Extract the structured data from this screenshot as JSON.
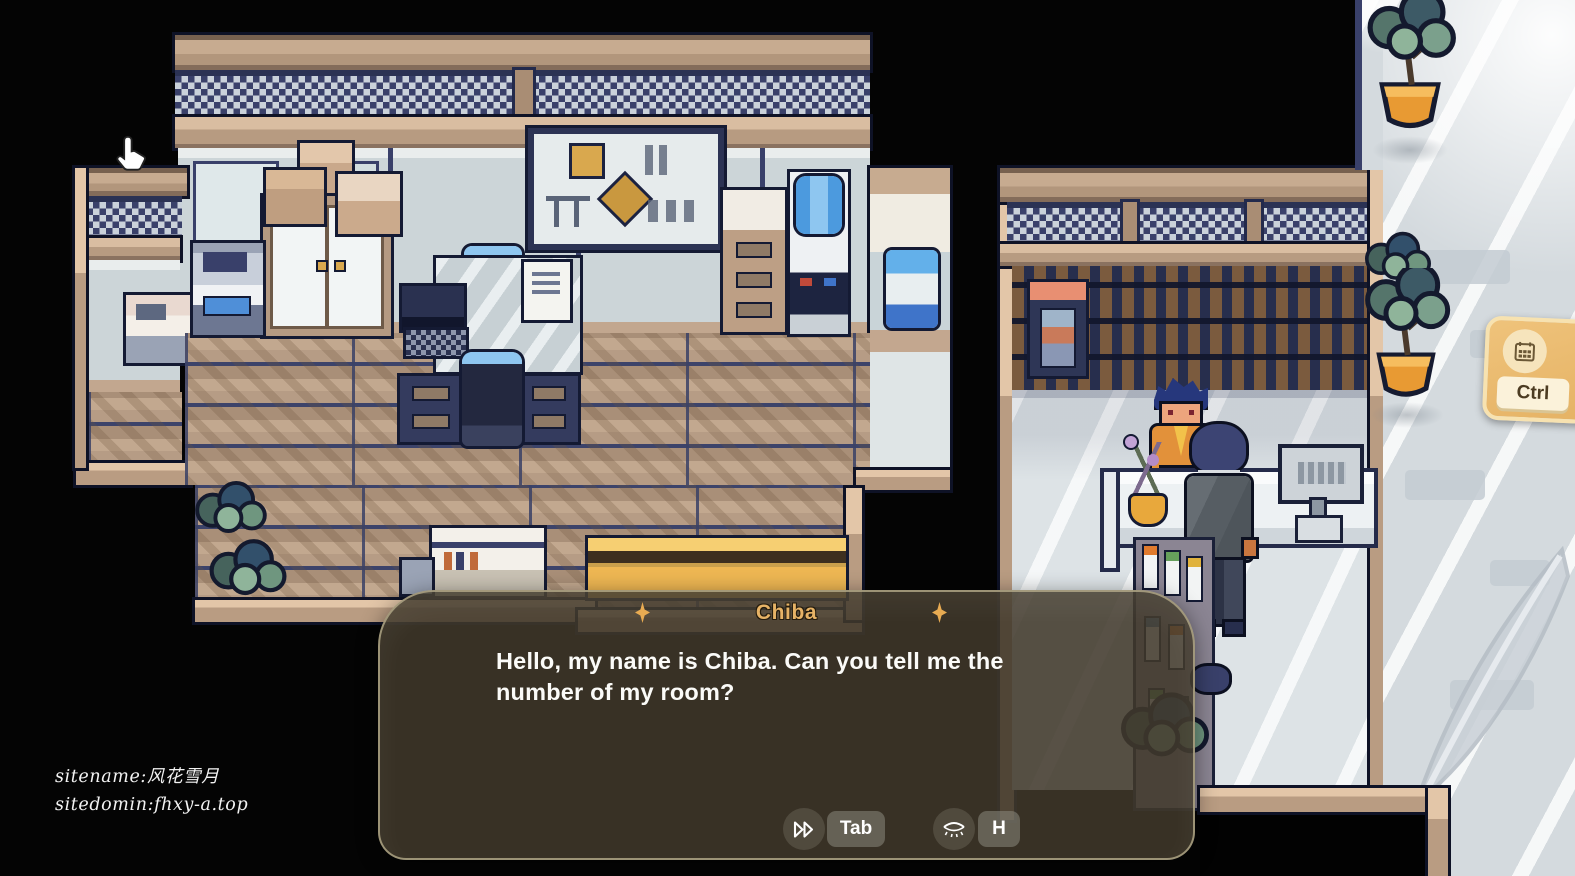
{
  "dialogue": {
    "speaker": "Chiba",
    "text": "Hello, my name is Chiba. Can you tell me the number of my room?",
    "controls": [
      {
        "icon": "fast-forward-icon",
        "key": "Tab",
        "action": "skip"
      },
      {
        "icon": "eye-closed-icon",
        "key": "H",
        "action": "hide-ui"
      }
    ]
  },
  "hud": {
    "hotkey_card": {
      "icon": "calendar-icon",
      "key_label": "Ctrl"
    },
    "watermark": {
      "line1": "sitename:风花雪月",
      "line2": "sitedomin:fhxy-a.top"
    },
    "cursor": "hand-pointer-cursor"
  },
  "scene": {
    "left_room": "office with desk, cabinet, whiteboard, water cooler, bench and plants",
    "right_room": "reception lobby with counter, register, receptionist and guest",
    "characters": [
      "receptionist",
      "guest-chiba"
    ],
    "outdoor": "marble courtyard with potted plants"
  },
  "colors": {
    "speaker_gold": "#E7B366",
    "spark_gold": "#E8AB52",
    "dialog_bg": "rgba(64,56,43,0.87)",
    "button_gray": "#8A887E",
    "hotkey_card": "#E9B96F",
    "keycap": "#FBF2DA",
    "pot_orange": "#E89A33"
  }
}
